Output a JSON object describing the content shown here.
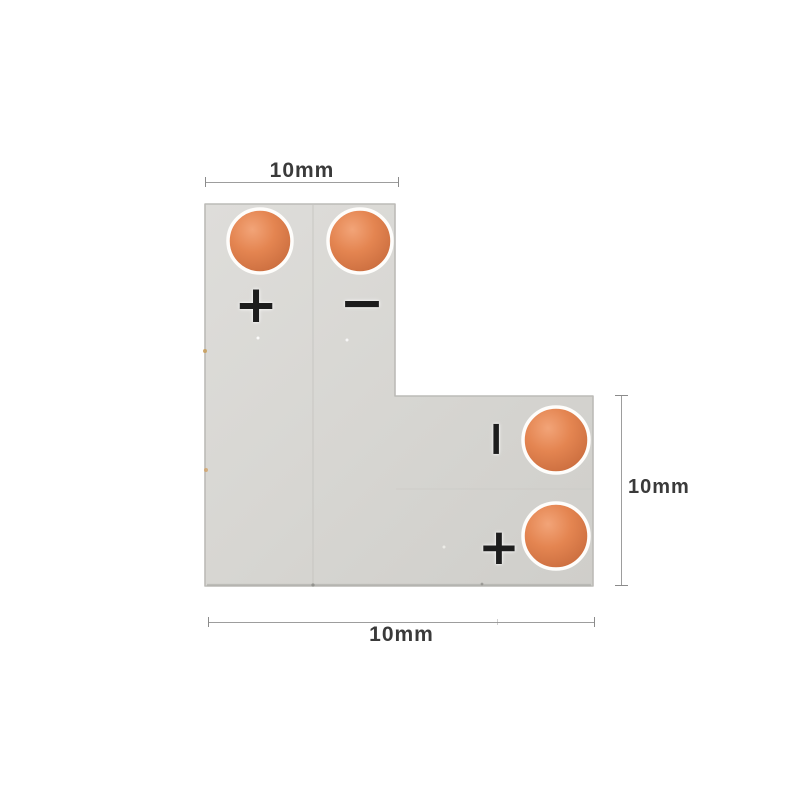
{
  "image": {
    "description": "L-shape LED strip connector PCB with dimension annotations",
    "background_color": "#ffffff"
  },
  "pcb": {
    "shape": "L",
    "body_color": "#d7d6d2",
    "edge_color": "#bcbbb7",
    "pad_color": "#e2824e",
    "pad_ring_color": "#fefdfb",
    "pads": [
      "top-left",
      "top-right",
      "right-top",
      "right-bottom"
    ],
    "marks": {
      "plus_top": {
        "glyph": "+"
      },
      "minus_top": {
        "glyph": "−"
      },
      "minus_right": {
        "glyph": "−",
        "orientation": "vertical"
      },
      "plus_right": {
        "glyph": "+"
      }
    }
  },
  "dimensions": {
    "line_color": "#9d9d9d",
    "text_color": "#3a3a3a",
    "top": {
      "label": "10mm"
    },
    "right": {
      "label": "10mm"
    },
    "bottom": {
      "label": "10mm"
    }
  }
}
